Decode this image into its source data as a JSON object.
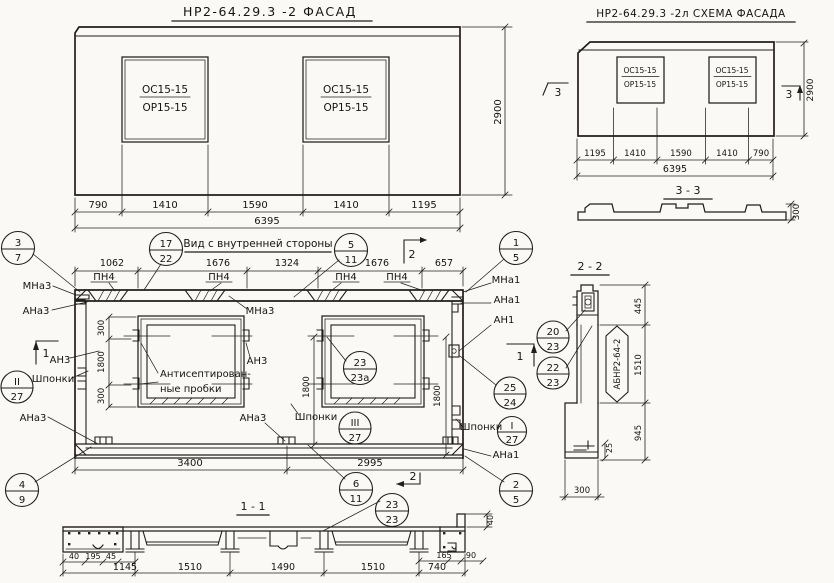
{
  "titles": {
    "facade": "НР2-64.29.3 -2  ФАСАД",
    "schema": "НР2-64.29.3  -2л  СХЕМА ФАСАДА",
    "inner": "Вид с внутренней стороны",
    "s11": "1 - 1",
    "s22": "2 - 2",
    "s33": "3 - 3"
  },
  "window": {
    "top": "ОС15-15",
    "bottom": "ОР15-15"
  },
  "facade": {
    "dims": [
      "790",
      "1410",
      "1590",
      "1410",
      "1195"
    ],
    "total": "6395",
    "height": "2900"
  },
  "schema": {
    "dims": [
      "1195",
      "1410",
      "1590",
      "1410",
      "790"
    ],
    "total": "6395",
    "height": "2900",
    "marker": "3",
    "s33_height": "300"
  },
  "inner": {
    "dims_top": [
      "1062",
      "1676",
      "1324",
      "1676",
      "657"
    ],
    "dims_bottom": [
      "3400",
      "2995"
    ],
    "dim_300a": "300",
    "dim_1800a": "1800",
    "dim_300b": "300",
    "dim_1800b": "1800",
    "dim_1800c": "1800",
    "pn4": "ПН4",
    "mna3": "МНа3",
    "ana3": "АНа3",
    "an3": "АН3",
    "mna1": "МНа1",
    "ana1": "АНа1",
    "an1": "АН1",
    "shponki": "Шпонки",
    "plugs1": "Антисептирован-",
    "plugs2": "ные пробки",
    "m1": "1",
    "m2": "2"
  },
  "callouts": {
    "c37": {
      "t": "3",
      "b": "7"
    },
    "c1722": {
      "t": "17",
      "b": "22"
    },
    "c511": {
      "t": "5",
      "b": "11"
    },
    "c15": {
      "t": "1",
      "b": "5"
    },
    "c227": {
      "t": "II",
      "b": "27"
    },
    "c49": {
      "t": "4",
      "b": "9"
    },
    "c2323a": {
      "t": "23",
      "b": "23а"
    },
    "c327": {
      "t": "III",
      "b": "27"
    },
    "c2524": {
      "t": "25",
      "b": "24"
    },
    "c127": {
      "t": "I",
      "b": "27"
    },
    "c611": {
      "t": "6",
      "b": "11"
    },
    "c2323": {
      "t": "23",
      "b": "23"
    },
    "c25b": {
      "t": "2",
      "b": "5"
    },
    "c2023": {
      "t": "20",
      "b": "23"
    },
    "c2223": {
      "t": "22",
      "b": "23"
    }
  },
  "s11": {
    "sub_left": [
      "40",
      "195",
      "45"
    ],
    "dims": [
      "1145",
      "1510",
      "1490",
      "1510",
      "740"
    ],
    "sub_right": [
      "165",
      "90"
    ],
    "v40": "40"
  },
  "s22": {
    "mark": "АБНР2-64-2",
    "d445": "445",
    "d1510": "1510",
    "d945": "945",
    "d25": "25",
    "d300": "300"
  }
}
